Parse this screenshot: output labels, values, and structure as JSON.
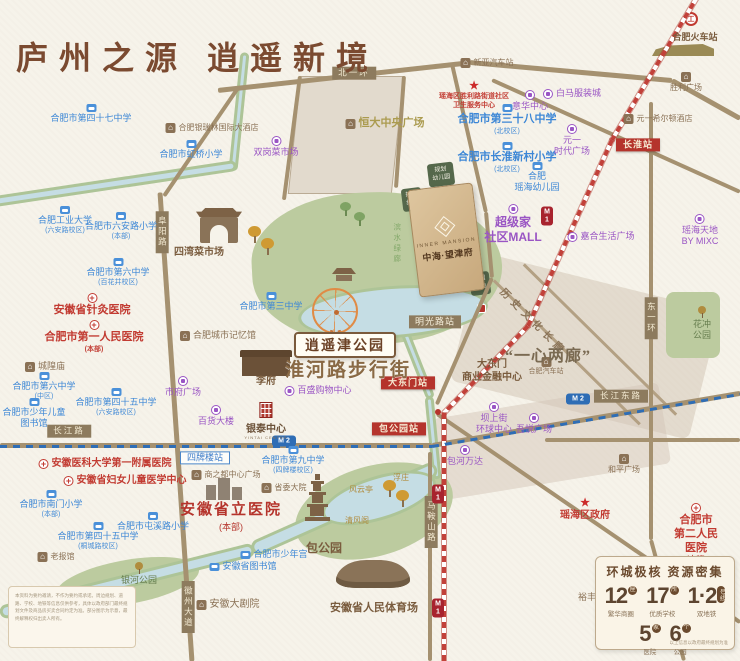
{
  "title": "庐州之源  逍遥新境",
  "project": {
    "en": "INNER MANSION",
    "name": "中海·望津府"
  },
  "parcels": {
    "kindergarten": "规划\n幼儿园",
    "green": "规划\n绿地",
    "park_green": "公园\n绿地"
  },
  "big": {
    "xiaoyaojin": "逍遥津公园",
    "huaihe": "淮河路步行街",
    "yixin": "“一心两廊”",
    "corridor": "历史文化长廊"
  },
  "hospital": {
    "name": "安徽省立医院",
    "sub": "(本部)"
  },
  "yintai": {
    "name": "银泰中心",
    "en": "YINTAI CENTRE"
  },
  "metro": {
    "m": "M",
    "l1": "1",
    "l2": "2",
    "rail_logo": "工"
  },
  "stats": {
    "title": "环城极核  资源密集",
    "items": [
      {
        "num": "12",
        "unit": "座",
        "label": "繁华商圈"
      },
      {
        "num": "17",
        "unit": "所",
        "label": "优质学校"
      },
      {
        "num": "1·2",
        "unit": "号线",
        "label": "双地铁"
      },
      {
        "num": "5",
        "unit": "家",
        "label": "医院"
      },
      {
        "num": "6",
        "unit": "个",
        "label": "公园"
      }
    ],
    "note": "以上信息以政府最终规划为准"
  },
  "disclaimer": {
    "text": "本资料为要约邀请，不作为要约或承诺。周边规划、道路、学校、地铁等信息仅供参考，具体以政府部门最终规划文件及商品房买卖合同约定为准。部分图示为示意，最终解释权归出卖人所有。"
  },
  "labels": [
    {
      "n": "school-no47-middle",
      "t": "school",
      "x": 91,
      "y": 104,
      "text": "合肥市第四十七中学"
    },
    {
      "n": "school-hongqiao-primary",
      "t": "school",
      "x": 191,
      "y": 140,
      "text": "合肥市虹桥小学"
    },
    {
      "n": "school-hfut",
      "t": "school",
      "x": 65,
      "y": 206,
      "text": "合肥工业大学",
      "sub": "(六安路校区)"
    },
    {
      "n": "school-luanlu-primary",
      "t": "school",
      "x": 121,
      "y": 212,
      "text": "合肥市六安路小学",
      "sub": "(本部)"
    },
    {
      "n": "school-no6-baihuajing",
      "t": "school",
      "x": 118,
      "y": 258,
      "text": "合肥市第六中学",
      "sub": "(百花井校区)"
    },
    {
      "n": "school-no3-middle",
      "t": "school",
      "x": 271,
      "y": 292,
      "text": "合肥市第三中学"
    },
    {
      "n": "school-no38-north",
      "t": "school",
      "x": 507,
      "y": 104,
      "s": 11,
      "b": 1,
      "text": "合肥市第三十八中学",
      "sub": "(北校区)"
    },
    {
      "n": "school-changhuai-primary",
      "t": "school",
      "x": 507,
      "y": 142,
      "s": 11,
      "b": 1,
      "text": "合肥市长淮新村小学",
      "sub": "(北校区)"
    },
    {
      "n": "school-yaohai-kindergarten",
      "t": "school",
      "x": 537,
      "y": 162,
      "text": "合肥\n瑶海幼儿园"
    },
    {
      "n": "school-no6-center",
      "t": "school",
      "x": 44,
      "y": 372,
      "text": "合肥市第六中学",
      "sub": "(中区)"
    },
    {
      "n": "library-children",
      "t": "school",
      "x": 34,
      "y": 398,
      "text": "合肥市少年儿童\n图书馆"
    },
    {
      "n": "school-no45-luanlu",
      "t": "school",
      "x": 116,
      "y": 388,
      "text": "合肥市第四十五中学",
      "sub": "(六安路校区)"
    },
    {
      "n": "school-nanmen-primary",
      "t": "school",
      "x": 51,
      "y": 490,
      "text": "合肥市南门小学",
      "sub": "(本部)"
    },
    {
      "n": "school-no45-tongcheng",
      "t": "school",
      "x": 98,
      "y": 522,
      "text": "合肥市第四十五中学",
      "sub": "(桐城路校区)"
    },
    {
      "n": "school-tunxilu-primary",
      "t": "school",
      "x": 153,
      "y": 512,
      "text": "合肥市屯溪路小学"
    },
    {
      "n": "school-no9-middle",
      "t": "school",
      "x": 293,
      "y": 446,
      "text": "合肥市第九中学",
      "sub": "(四牌楼校区)"
    },
    {
      "n": "youth-palace",
      "t": "school",
      "i": 1,
      "x": 274,
      "y": 549,
      "text": "合肥市少年宫"
    },
    {
      "n": "anhui-library",
      "t": "school",
      "i": 1,
      "x": 243,
      "y": 561,
      "text": "安徽省图书馆"
    },
    {
      "n": "hospital-acupuncture",
      "t": "hosp",
      "x": 92,
      "y": 293,
      "s": 11,
      "text": "安徽省针灸医院"
    },
    {
      "n": "hospital-first-people",
      "t": "hosp",
      "x": 94,
      "y": 320,
      "s": 11,
      "text": "合肥市第一人民医院",
      "sub": "(本部)"
    },
    {
      "n": "hospital-anmed-first",
      "t": "hosp",
      "i": 1,
      "x": 105,
      "y": 458,
      "s": 10,
      "text": "安徽医科大学第一附属医院"
    },
    {
      "n": "hospital-women-children",
      "t": "hosp",
      "i": 1,
      "x": 125,
      "y": 475,
      "s": 10,
      "text": "安徽省妇女儿童医学中心"
    },
    {
      "n": "hospital-second-people",
      "t": "hosp",
      "x": 696,
      "y": 503,
      "s": 11,
      "b": 1,
      "text": "合肥市\n第二人民医院",
      "sub": "(本部)"
    },
    {
      "n": "gov-yaohai-district",
      "t": "gov",
      "x": 585,
      "y": 498,
      "text": "瑶海区政府"
    },
    {
      "n": "gov-health-center",
      "t": "gov",
      "x": 474,
      "y": 81,
      "s": 7,
      "text": "瑶海区胜利路街道社区\n卫生服务中心"
    },
    {
      "n": "mall-shuanggang-market",
      "t": "mall",
      "x": 276,
      "y": 136,
      "text": "双岗菜市场"
    },
    {
      "n": "mall-baima-clothing",
      "t": "mall",
      "i": 1,
      "x": 572,
      "y": 88,
      "text": "白马服装城"
    },
    {
      "n": "mall-yihua-center",
      "t": "mall",
      "x": 530,
      "y": 90,
      "text": "意华中心"
    },
    {
      "n": "mall-yuanyi-times",
      "t": "mall",
      "x": 572,
      "y": 124,
      "text": "元一\n时代广场"
    },
    {
      "n": "mall-superhome-community",
      "t": "mall",
      "x": 513,
      "y": 204,
      "s": 12,
      "b": 1,
      "text": "超级家\n社区MALL"
    },
    {
      "n": "mall-yaohai-mixc",
      "t": "mall",
      "x": 700,
      "y": 214,
      "text": "瑶海天地\nBY MIXC"
    },
    {
      "n": "mall-jiahe-life",
      "t": "mall",
      "i": 1,
      "x": 601,
      "y": 231,
      "text": "嘉合生活广场"
    },
    {
      "n": "mall-shifu-square",
      "t": "mall",
      "x": 183,
      "y": 376,
      "text": "市府广场"
    },
    {
      "n": "mall-department-store",
      "t": "mall",
      "x": 216,
      "y": 405,
      "text": "百货大楼"
    },
    {
      "n": "mall-parkson",
      "t": "mall",
      "i": 1,
      "x": 318,
      "y": 385,
      "text": "百盛购物中心"
    },
    {
      "n": "mall-bashangjie-global",
      "t": "mall",
      "x": 494,
      "y": 402,
      "text": "坝上街\n环球中心"
    },
    {
      "n": "mall-wuyue-plaza",
      "t": "mall",
      "x": 534,
      "y": 413,
      "text": "吾悦广场"
    },
    {
      "n": "mall-baohe-wanda",
      "t": "mall",
      "x": 465,
      "y": 445,
      "text": "包河万达"
    },
    {
      "n": "venue-xinya-bus-station",
      "t": "venue",
      "i": 1,
      "x": 487,
      "y": 58,
      "s": 8,
      "text": "新亚汽车站"
    },
    {
      "n": "venue-yinruilin-hotel",
      "t": "venue",
      "i": 1,
      "x": 212,
      "y": 123,
      "s": 8,
      "text": "合肥银瑞林国际大酒店"
    },
    {
      "n": "venue-hengda-central-plaza",
      "t": "gold",
      "i": 1,
      "x": 385,
      "y": 117,
      "text": "恒大中央广场"
    },
    {
      "n": "venue-siwan-market",
      "t": "venueb",
      "x": 199,
      "y": 247,
      "text": "四湾菜市场"
    },
    {
      "n": "venue-city-memory-hall",
      "t": "venue",
      "i": 1,
      "x": 218,
      "y": 330,
      "text": "合肥城市记忆馆"
    },
    {
      "n": "venue-chenghuang-temple",
      "t": "venue",
      "i": 1,
      "x": 45,
      "y": 361,
      "text": "城隍庙"
    },
    {
      "n": "venue-shengli-square",
      "t": "venue",
      "x": 686,
      "y": 72,
      "s": 8,
      "text": "胜利广场"
    },
    {
      "n": "venue-dadongmen-finance",
      "t": "venueb",
      "x": 492,
      "y": 359,
      "s": 10,
      "text": "大东门\n商业金融中心"
    },
    {
      "n": "venue-hefei-bus-station",
      "t": "venue",
      "x": 546,
      "y": 357,
      "s": 7,
      "text": "合肥汽车站"
    },
    {
      "n": "venue-heping-square",
      "t": "venue",
      "x": 624,
      "y": 454,
      "s": 8,
      "text": "和平广场"
    },
    {
      "n": "venue-shangzhidu-plaza",
      "t": "venue",
      "i": 1,
      "x": 226,
      "y": 470,
      "s": 8,
      "text": "商之都中心广场"
    },
    {
      "n": "venue-shengwei-compound",
      "t": "venue",
      "i": 1,
      "x": 284,
      "y": 483,
      "s": 8,
      "text": "省委大院"
    },
    {
      "n": "venue-fengyun-pavilion",
      "t": "goldsm",
      "x": 361,
      "y": 485,
      "text": "风云亭"
    },
    {
      "n": "venue-fuzhuang",
      "t": "goldsm",
      "x": 401,
      "y": 473,
      "text": "浮庄"
    },
    {
      "n": "venue-qingfeng-pavilion",
      "t": "goldsm",
      "x": 357,
      "y": 516,
      "text": "清风阁"
    },
    {
      "n": "venue-baogong-park",
      "t": "venueb",
      "x": 324,
      "y": 541,
      "s": 12,
      "text": "包公园"
    },
    {
      "n": "venue-laobaoguan",
      "t": "venue",
      "i": 1,
      "x": 56,
      "y": 552,
      "s": 8,
      "text": "老报馆"
    },
    {
      "n": "venue-anhui-grand-theatre",
      "t": "venue",
      "i": 1,
      "x": 228,
      "y": 599,
      "s": 10,
      "text": "安徽大剧院"
    },
    {
      "n": "venue-people-stadium",
      "t": "venueb",
      "x": 374,
      "y": 602,
      "s": 11,
      "text": "安徽省人民体育场"
    },
    {
      "n": "venue-yufeng-market",
      "t": "brownsm",
      "x": 614,
      "y": 592,
      "s": 9,
      "text": "裕丰花鸟鱼虫市场"
    },
    {
      "n": "venue-hilton-hotel",
      "t": "venue",
      "i": 1,
      "x": 658,
      "y": 114,
      "s": 8,
      "text": "元一希尔顿酒店"
    },
    {
      "n": "venue-hefei-railway-station",
      "t": "venueb",
      "x": 695,
      "y": 32,
      "s": 9,
      "text": "合肥火车站"
    },
    {
      "n": "park-huachong",
      "t": "parkl",
      "x": 702,
      "y": 306,
      "text": "花冲\n公园"
    },
    {
      "n": "park-yinhe",
      "t": "parkl",
      "x": 139,
      "y": 562,
      "text": "银河公园"
    },
    {
      "n": "venue-lifu",
      "t": "venueb",
      "x": 266,
      "y": 376,
      "s": 10,
      "text": "李府"
    },
    {
      "n": "station-changhuai",
      "t": "stred",
      "x": 638,
      "y": 145,
      "text": "长淮站"
    },
    {
      "n": "station-mingguanglu",
      "t": "stbrown",
      "x": 435,
      "y": 322,
      "text": "明光路站"
    },
    {
      "n": "station-dadongmen",
      "t": "stred",
      "x": 408,
      "y": 383,
      "text": "大东门站"
    },
    {
      "n": "station-baogongyuan",
      "t": "stred",
      "x": 399,
      "y": 429,
      "text": "包公园站"
    },
    {
      "n": "station-sipailou",
      "t": "stblue",
      "x": 205,
      "y": 458,
      "text": "四牌楼站"
    },
    {
      "n": "road-label-beiyihuan",
      "t": "road",
      "x": 354,
      "y": 73,
      "text": "北一环"
    },
    {
      "n": "road-label-fuyanglu",
      "t": "roadv",
      "x": 162,
      "y": 232,
      "text": "阜阳路"
    },
    {
      "n": "road-label-dongyihuan",
      "t": "roadv",
      "x": 651,
      "y": 318,
      "text": "东一环"
    },
    {
      "n": "road-label-changjianglu",
      "t": "road",
      "x": 69,
      "y": 431,
      "text": "长江路"
    },
    {
      "n": "road-label-changjiangdonglu",
      "t": "road",
      "x": 621,
      "y": 396,
      "text": "长江东路"
    },
    {
      "n": "road-label-maanshanlu",
      "t": "roadv",
      "x": 431,
      "y": 522,
      "text": "马鞍山路"
    },
    {
      "n": "road-label-huizhoudadao",
      "t": "roadv",
      "x": 188,
      "y": 607,
      "text": "徽州大道"
    },
    {
      "n": "green-corridor-label",
      "t": "greenv",
      "x": 397,
      "y": 244,
      "text": "滨水绿廊"
    }
  ]
}
